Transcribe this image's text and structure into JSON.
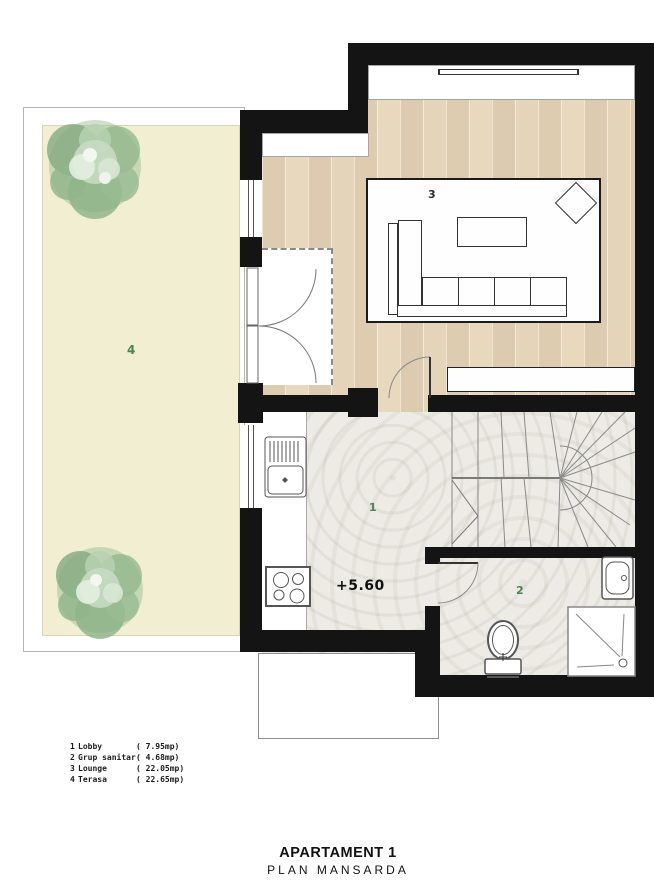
{
  "plan": {
    "level_marker": "+5.60",
    "room_numbers": {
      "lobby": "1",
      "bathroom": "2",
      "lounge": "3",
      "terrace": "4"
    }
  },
  "legend": {
    "items": [
      {
        "number": "1",
        "name": "Lobby",
        "area": "( 7.95mp)"
      },
      {
        "number": "2",
        "name": "Grup sanitar",
        "area": "( 4.68mp)"
      },
      {
        "number": "3",
        "name": "Lounge",
        "area": "( 22.05mp)"
      },
      {
        "number": "4",
        "name": "Terasa",
        "area": "( 22.65mp)"
      }
    ]
  },
  "title_block": {
    "title": "APARTAMENT 1",
    "subtitle": "PLAN MANSARDA"
  },
  "colors": {
    "wall": "#141414",
    "terrace_floor": "#f1eed1",
    "parquet_floor": "#e8dcc6",
    "marble_floor": "#edebe5",
    "room_label_green": "#4e8153",
    "tree_green": "#9dbf98"
  }
}
